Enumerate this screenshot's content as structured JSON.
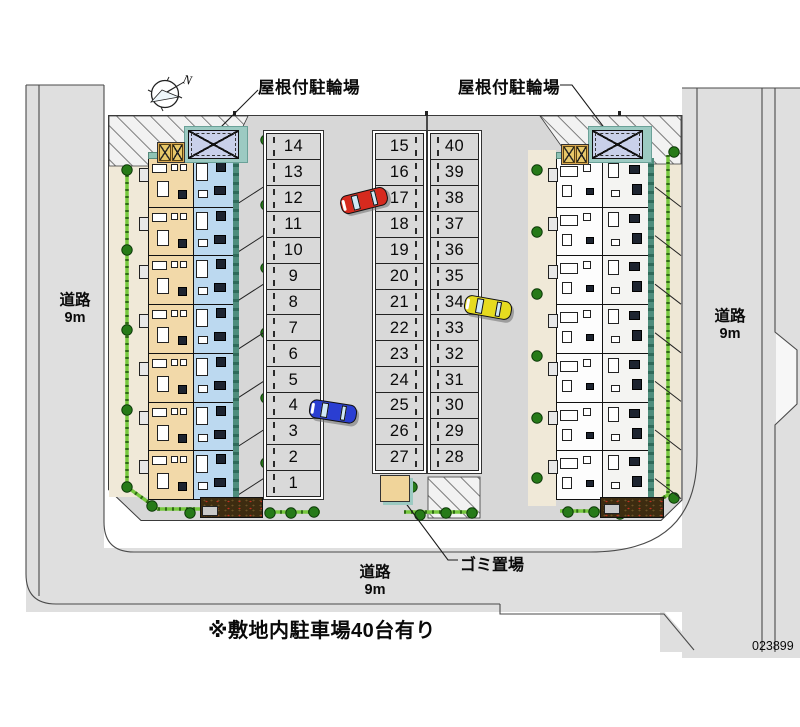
{
  "labels": {
    "covered_bicycle_parking_left": "屋根付駐輪場",
    "covered_bicycle_parking_right": "屋根付駐輪場",
    "garbage_area": "ゴミ置場",
    "site_note": "※敷地内駐車場40台有り",
    "plan_number": "023899",
    "compass_north": "N"
  },
  "roads": {
    "left": {
      "name": "道路",
      "width": "9m"
    },
    "right": {
      "name": "道路",
      "width": "9m"
    },
    "bottom": {
      "name": "道路",
      "width": "9m"
    }
  },
  "parking": {
    "left_column": [
      "14",
      "13",
      "12",
      "11",
      "10",
      "9",
      "8",
      "7",
      "6",
      "5",
      "4",
      "3",
      "2",
      "1"
    ],
    "middle_column": [
      "15",
      "16",
      "17",
      "18",
      "19",
      "20",
      "21",
      "22",
      "23",
      "24",
      "25",
      "26",
      "27"
    ],
    "right_column": [
      "40",
      "39",
      "38",
      "37",
      "36",
      "35",
      "34",
      "33",
      "32",
      "31",
      "30",
      "29",
      "28"
    ]
  },
  "cars": [
    {
      "name": "red-car",
      "color": "#d62a1e"
    },
    {
      "name": "yellow-car",
      "color": "#e6db1f"
    },
    {
      "name": "blue-car",
      "color": "#2a3ed2"
    }
  ],
  "colors": {
    "building_left_tan": "#f2d9a9",
    "building_left_blue": "#bcd9f0",
    "building_right_white": "#fdfdfd",
    "hedge_green": "#76c83e",
    "tree_green": "#267a18",
    "bike_shelter_teal": "#9ccac2",
    "bike_shelter_box": "#c9d0ea",
    "garbage_box_tan": "#f0d49a",
    "road_gray": "#dfdfdf",
    "pavement_gray": "#d7d7d7"
  }
}
